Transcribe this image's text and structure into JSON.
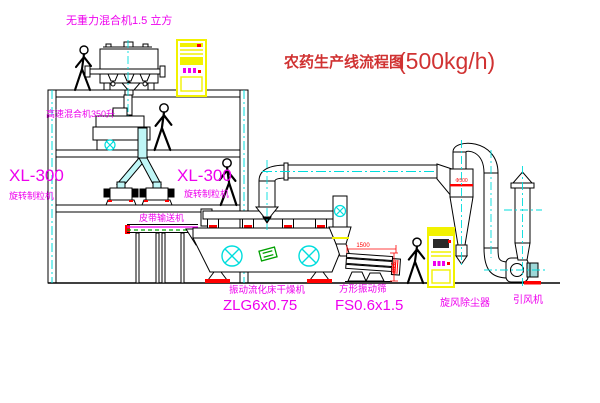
{
  "diagram": {
    "title": "农药生产线流程图",
    "capacity": "(500kg/h)"
  },
  "equipment": {
    "gravity_free_mixer": {
      "label": "无重力混合机1.5 立方"
    },
    "high_speed_mixer": {
      "label": "高速混合机350升"
    },
    "granulator_left": {
      "model": "XL-300",
      "name": "旋转制粒机"
    },
    "granulator_right": {
      "model": "XL-300",
      "name": "旋转制粒机"
    },
    "belt_conveyor": {
      "label": "皮带输送机"
    },
    "fluid_bed_dryer": {
      "name": "振动流化床干燥机",
      "model": "ZLG6x0.75"
    },
    "square_screen": {
      "name": "方形振动筛",
      "model": "FS0.6x1.5",
      "dim_length": "1500",
      "dim_height": "340"
    },
    "cyclone": {
      "label": "旋风除尘器",
      "dim": "Φ500"
    },
    "fan": {
      "label": "引风机"
    }
  },
  "colors": {
    "label": "#ee00ee",
    "title": "#d03232",
    "dimension": "#ff0000",
    "centerline": "#00dddd",
    "cabinet": "#f2f200",
    "conveyor_green": "#00a000"
  }
}
